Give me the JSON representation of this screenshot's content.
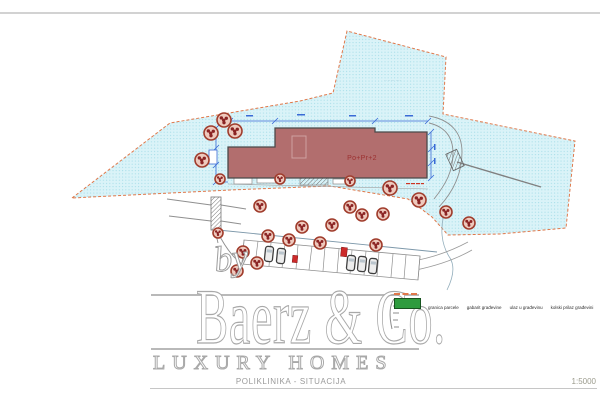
{
  "titleblock": {
    "drawing_title": "POLIKLINIKA - SITUACIJA",
    "scale_label": "1:5000"
  },
  "watermark": {
    "by": "by",
    "brand": "Baerz & Co.",
    "tagline": "LUXURY HOMES"
  },
  "legend": {
    "items": [
      {
        "label": "granica parcele"
      },
      {
        "label": "gabarit građevine"
      },
      {
        "label": "ulaz u građevinu"
      },
      {
        "label": "kolski prilaz građevini"
      }
    ]
  },
  "plan": {
    "building_label": "Po+Pr+2",
    "parcel_annotation": "·· ····· ····",
    "colors": {
      "parcel_fill": "#daf3f8",
      "parcel_dot": "#a5dde8",
      "parcel_border": "#e0784a",
      "building_fill": "#b26e6e",
      "building_outline": "#4a4a4a",
      "building_label": "#9c3030",
      "tree_ring": "#a03c2c",
      "tree_fill": "#eec9bd",
      "tree_dot": "#8b2424",
      "dimension_blue": "#3a6bd6",
      "road_gray": "#8a8a8a",
      "legend_green": "#2e9b3e",
      "marker_red": "#cc2a2a",
      "watermark_gray": "#a8a8a8"
    },
    "trees": [
      [
        224,
        120,
        7
      ],
      [
        211,
        133,
        7
      ],
      [
        235,
        131,
        7
      ],
      [
        202,
        160,
        7
      ],
      [
        220,
        179,
        5
      ],
      [
        280,
        179,
        5
      ],
      [
        350,
        181,
        5
      ],
      [
        390,
        188,
        7
      ],
      [
        419,
        200,
        7
      ],
      [
        446,
        212,
        6
      ],
      [
        469,
        223,
        6
      ],
      [
        260,
        206,
        6
      ],
      [
        350,
        207,
        6
      ],
      [
        362,
        215,
        6
      ],
      [
        383,
        214,
        6
      ],
      [
        302,
        227,
        6
      ],
      [
        332,
        225,
        6
      ],
      [
        268,
        236,
        6
      ],
      [
        289,
        240,
        6
      ],
      [
        320,
        243,
        6
      ],
      [
        376,
        245,
        6
      ],
      [
        243,
        252,
        6
      ],
      [
        257,
        263,
        6
      ],
      [
        237,
        271,
        6
      ],
      [
        218,
        233,
        5
      ]
    ],
    "cars": [
      [
        269,
        254
      ],
      [
        281,
        256
      ],
      [
        351,
        263
      ],
      [
        362,
        264
      ],
      [
        373,
        266
      ]
    ],
    "red_markers": [
      [
        344,
        252,
        6,
        9
      ],
      [
        295,
        259,
        5,
        7
      ]
    ]
  }
}
